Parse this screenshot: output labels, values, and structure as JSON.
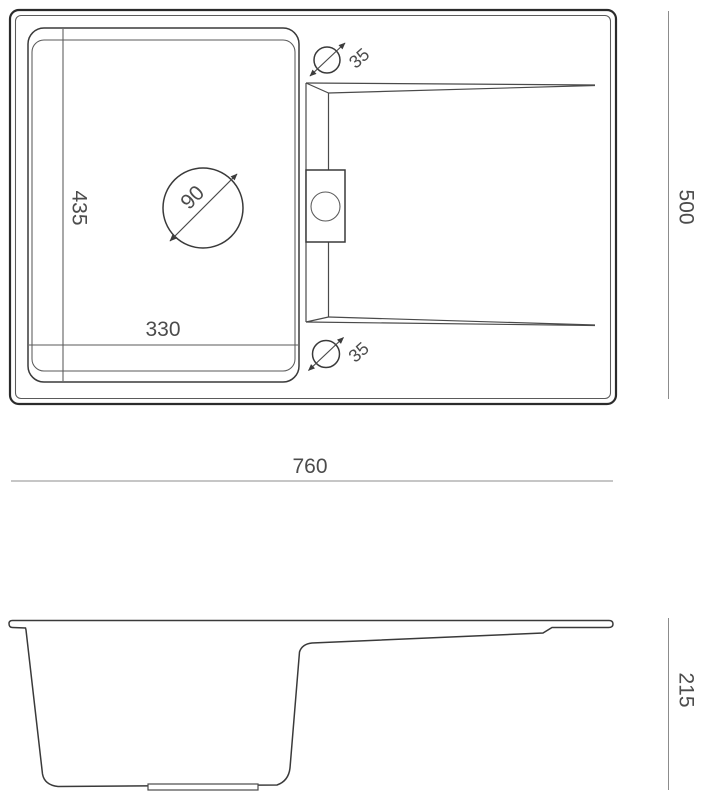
{
  "dims": {
    "overall_width": "760",
    "overall_depth": "500",
    "bowl_width": "330",
    "bowl_depth": "435",
    "drain_diameter": "90",
    "tap_hole_top": "35",
    "tap_hole_bottom": "35",
    "side_height": "215"
  },
  "colors": {
    "outline": "#2b2b2b",
    "line": "#3a3a3a",
    "dimension_line": "#8c8c8c",
    "text": "#4c4c4c",
    "background": "#ffffff"
  }
}
